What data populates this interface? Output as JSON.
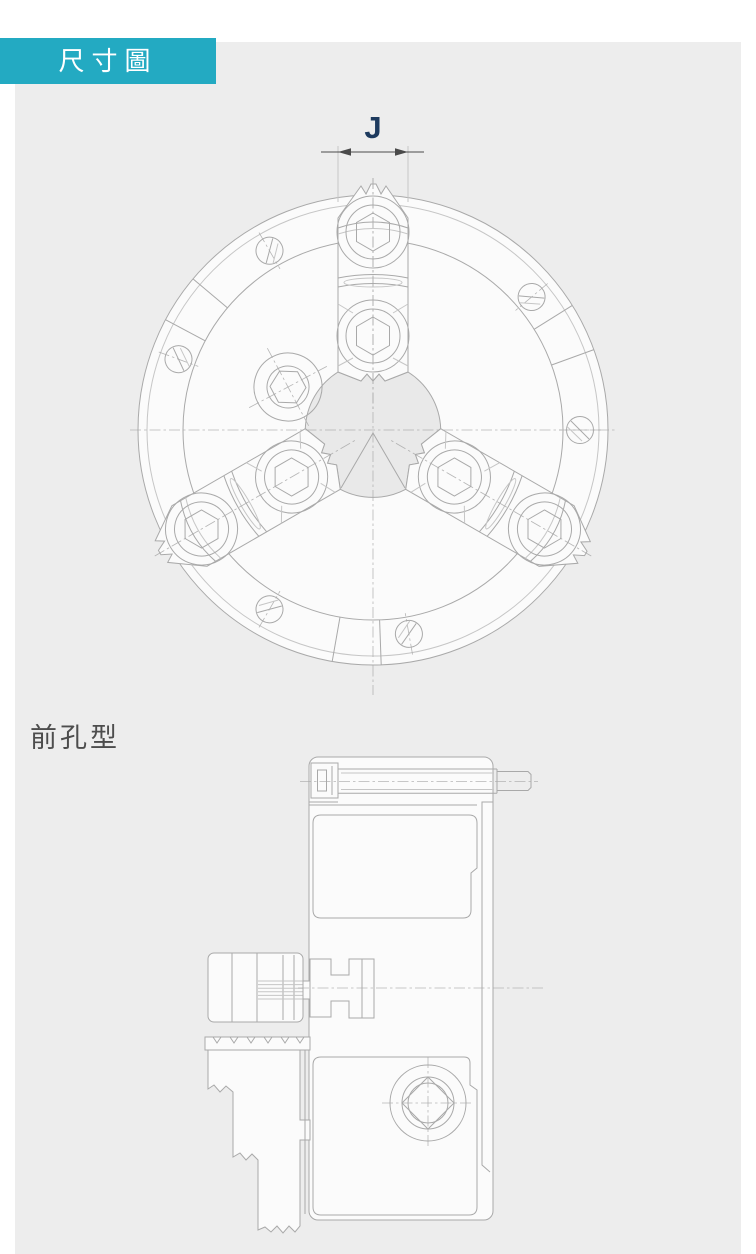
{
  "header": {
    "badge": "尺寸圖"
  },
  "front_view": {
    "name": "3-jaw chuck front view",
    "dimension_label": "J"
  },
  "side_view": {
    "section_label": "前孔型",
    "name": "chuck cross-section side view"
  },
  "colors": {
    "badge_bg": "#23aac2",
    "badge_text": "#ffffff",
    "panel_bg": "#ededed",
    "page_bg": "#ffffff",
    "line": "#a9a9a9",
    "line_light": "#c6c6c6",
    "dimension": "#4a4a4a",
    "dimension_label": "#1d3a5e",
    "section_label": "#4d4d4d",
    "fill": "#fbfbfb",
    "hole": "#e9e9e9"
  }
}
